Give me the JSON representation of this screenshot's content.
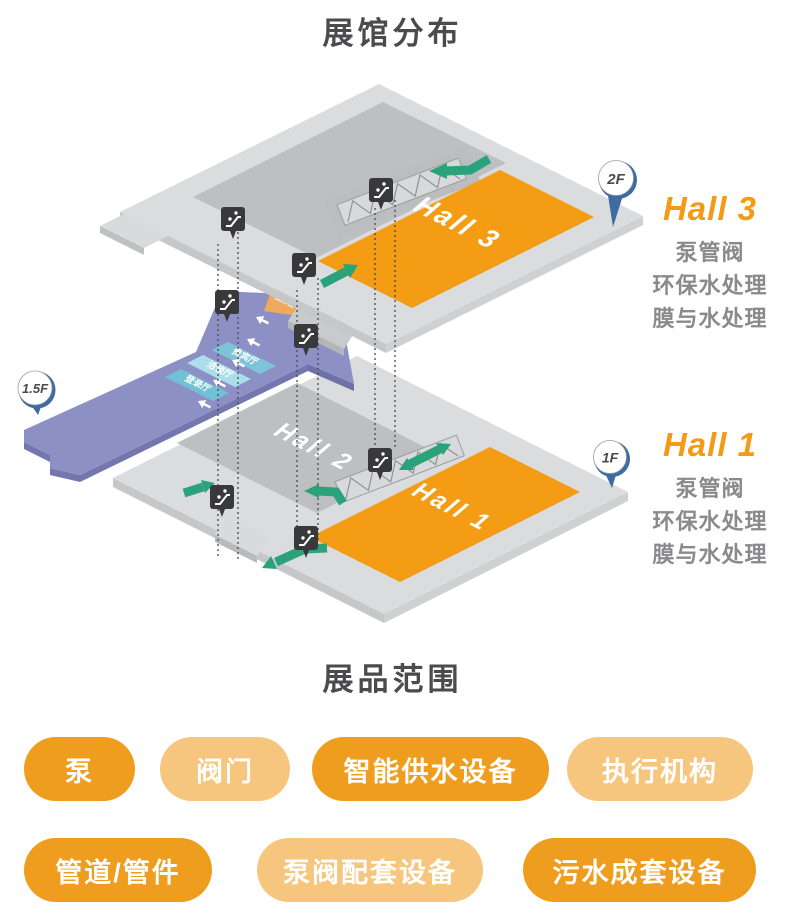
{
  "header": {
    "title": "展馆分布"
  },
  "map": {
    "floors": {
      "f2_pin": "2F",
      "f15_pin": "1.5F",
      "f1_pin": "1F",
      "hall3_floor_label": "Hall 3",
      "hall2_floor_label": "Hall 2",
      "hall1_floor_label": "Hall 1",
      "rooms": {
        "vip": "贵宾厅",
        "meeting": "洽谈厅",
        "registration": "登录厅",
        "service_area": "服务区"
      }
    },
    "legends": {
      "hall3": {
        "title": "Hall 3",
        "lines": [
          "泵管阀",
          "环保水处理",
          "膜与水处理"
        ]
      },
      "hall1": {
        "title": "Hall 1",
        "lines": [
          "泵管阀",
          "环保水处理",
          "膜与水处理"
        ]
      }
    }
  },
  "products": {
    "title": "展品范围",
    "pills": [
      {
        "label": "泵",
        "tone": "dark"
      },
      {
        "label": "阀门",
        "tone": "light"
      },
      {
        "label": "智能供水设备",
        "tone": "dark"
      },
      {
        "label": "执行机构",
        "tone": "light"
      },
      {
        "label": "管道/管件",
        "tone": "dark"
      },
      {
        "label": "泵阀配套设备",
        "tone": "light"
      },
      {
        "label": "污水成套设备",
        "tone": "dark"
      }
    ]
  },
  "colors": {
    "hall_orange": "#F49C13",
    "pill_dark": "#EF9D1F",
    "pill_light": "#F6C67E",
    "arrow_green": "#2AA37B",
    "floor_gray": "#DBDCDD",
    "inner_gray": "#BEBFC1",
    "mezzanine_purple": "#8D90C5",
    "pin_blue": "#3E6BA4",
    "room_teal": "#7EC4D8",
    "legend_text_gray": "#8A8A8C",
    "title_gray": "#4B4B4D"
  }
}
